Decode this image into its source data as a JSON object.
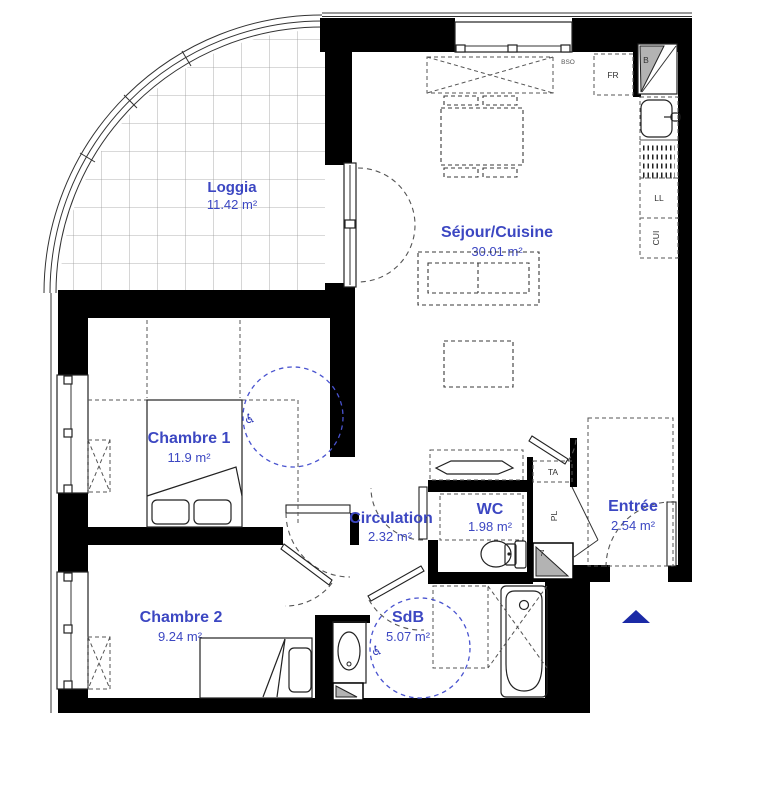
{
  "plan": {
    "type": "apartment-floor-plan",
    "rooms": [
      {
        "id": "loggia",
        "label": "Loggia",
        "area": "11.42 m²"
      },
      {
        "id": "sejour_cuisine",
        "label": "Séjour/Cuisine",
        "area": "30.01 m²"
      },
      {
        "id": "chambre1",
        "label": "Chambre 1",
        "area": "11.9 m²"
      },
      {
        "id": "circulation",
        "label": "Circulation",
        "area": "2.32 m²"
      },
      {
        "id": "wc",
        "label": "WC",
        "area": "1.98 m²"
      },
      {
        "id": "entree",
        "label": "Entrée",
        "area": "2.54 m²"
      },
      {
        "id": "chambre2",
        "label": "Chambre 2",
        "area": "9.24 m²"
      },
      {
        "id": "sdb",
        "label": "SdB",
        "area": "5.07 m²"
      }
    ],
    "annotations": {
      "fridge": "FR",
      "corner_unit": "B",
      "washing_machine": "LL",
      "cooker": "CUI",
      "technical_access": "TA",
      "closet": "PL",
      "duct_number": "7",
      "window_blind": "BSO"
    },
    "icons": {
      "accessibility_icon": "♿",
      "entrance_arrow_icon": "▲"
    },
    "colors": {
      "label_blue": "#3c47c2",
      "accessibility_blue": "#4953cf",
      "entrance_arrow_blue": "#1b2aa6",
      "wall_black": "#000000",
      "duct_gray": "#b3b3b3"
    }
  }
}
